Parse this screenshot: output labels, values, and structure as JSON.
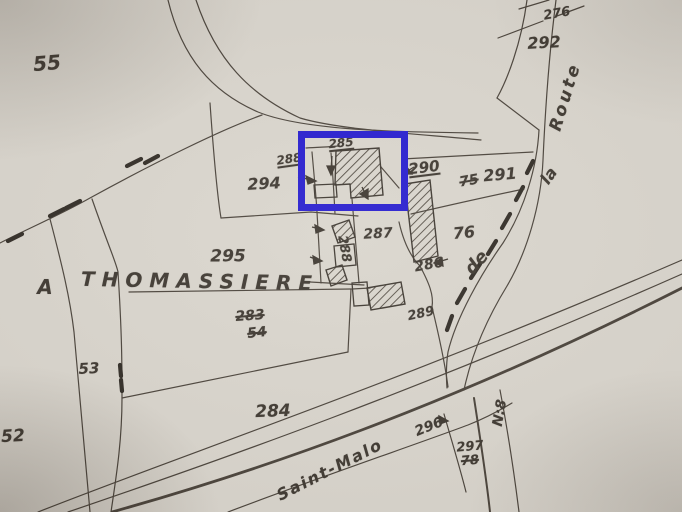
{
  "map_type": "cadastral parcel plan (scanned)",
  "palette": {
    "paper": "#d8d4cc",
    "ink": "#39332c",
    "hedge_ink": "#2c2721",
    "highlight_blue": "#2016ce"
  },
  "highlight_box": {
    "x": 298,
    "y": 131,
    "width": 110,
    "height": 80,
    "stroke_px": 7
  },
  "place_name": "A THOMASSIERE",
  "road_names": [
    "Route",
    "la",
    "de",
    "Saint-Malo",
    "N:8"
  ],
  "parcel_numbers_plain": [
    "55",
    "276",
    "292",
    "291",
    "76",
    "294",
    "287",
    "286",
    "289",
    "295",
    "53",
    "52",
    "284",
    "296",
    "297"
  ],
  "parcel_numbers_struck": [
    "75",
    "283",
    "54",
    "78"
  ],
  "parcel_numbers_underlined": [
    "290",
    "288",
    "285"
  ],
  "labels": [
    {
      "name": "parcel-label-55",
      "text": "55",
      "x": 47,
      "y": 63,
      "size": 20,
      "rot": -5,
      "style": "plain"
    },
    {
      "name": "parcel-label-276",
      "text": "276",
      "x": 557,
      "y": 14,
      "size": 13,
      "rot": -10,
      "style": "plain"
    },
    {
      "name": "parcel-label-292",
      "text": "292",
      "x": 544,
      "y": 43,
      "size": 16,
      "rot": -3,
      "style": "plain"
    },
    {
      "name": "road-label-route",
      "text": "Route",
      "x": 566,
      "y": 97,
      "size": 17,
      "rot": -73,
      "style": "plain",
      "spacing": 3
    },
    {
      "name": "road-label-la",
      "text": "la",
      "x": 549,
      "y": 176,
      "size": 16,
      "rot": -55,
      "style": "plain"
    },
    {
      "name": "road-label-de",
      "text": "de",
      "x": 477,
      "y": 263,
      "size": 18,
      "rot": -48,
      "style": "plain"
    },
    {
      "name": "parcel-label-290",
      "text": "290",
      "x": 424,
      "y": 168,
      "size": 15,
      "rot": -7,
      "style": "underline"
    },
    {
      "name": "parcel-label-75",
      "text": "75",
      "x": 469,
      "y": 181,
      "size": 14,
      "rot": -10,
      "style": "struck"
    },
    {
      "name": "parcel-label-291",
      "text": "291",
      "x": 500,
      "y": 175,
      "size": 16,
      "rot": -5,
      "style": "plain"
    },
    {
      "name": "parcel-label-76",
      "text": "76",
      "x": 464,
      "y": 233,
      "size": 16,
      "rot": -5,
      "style": "plain"
    },
    {
      "name": "parcel-label-294",
      "text": "294",
      "x": 264,
      "y": 184,
      "size": 16,
      "rot": -3,
      "style": "plain"
    },
    {
      "name": "parcel-label-288",
      "text": "288",
      "x": 289,
      "y": 159,
      "size": 12,
      "rot": -8,
      "style": "underline"
    },
    {
      "name": "parcel-label-285",
      "text": "285",
      "x": 341,
      "y": 143,
      "size": 12,
      "rot": -6,
      "style": "underline"
    },
    {
      "name": "parcel-label-287",
      "text": "287",
      "x": 378,
      "y": 234,
      "size": 14,
      "rot": -3,
      "style": "plain"
    },
    {
      "name": "parcel-label-288-vertical",
      "text": "288",
      "x": 344,
      "y": 249,
      "size": 13,
      "rot": 80,
      "style": "plain"
    },
    {
      "name": "parcel-label-286",
      "text": "286",
      "x": 429,
      "y": 265,
      "size": 14,
      "rot": -10,
      "style": "plain"
    },
    {
      "name": "parcel-label-289",
      "text": "289",
      "x": 421,
      "y": 314,
      "size": 13,
      "rot": -12,
      "style": "plain"
    },
    {
      "name": "parcel-label-295",
      "text": "295",
      "x": 228,
      "y": 257,
      "size": 17,
      "rot": 0,
      "style": "plain"
    },
    {
      "name": "place-label-a",
      "text": "A",
      "x": 45,
      "y": 287,
      "size": 20,
      "rot": 0,
      "style": "plain",
      "bold": true
    },
    {
      "name": "place-label-thomassiere",
      "text": "THOMASSIERE",
      "x": 200,
      "y": 281,
      "size": 20,
      "rot": 1,
      "style": "plain",
      "bold": true,
      "spacing": 7
    },
    {
      "name": "parcel-label-283",
      "text": "283",
      "x": 250,
      "y": 316,
      "size": 14,
      "rot": -4,
      "style": "struck"
    },
    {
      "name": "parcel-label-54",
      "text": "54",
      "x": 257,
      "y": 333,
      "size": 14,
      "rot": -6,
      "style": "struck"
    },
    {
      "name": "parcel-label-53",
      "text": "53",
      "x": 89,
      "y": 369,
      "size": 15,
      "rot": -3,
      "style": "plain"
    },
    {
      "name": "parcel-label-52",
      "text": "52",
      "x": 13,
      "y": 437,
      "size": 17,
      "rot": -3,
      "style": "plain"
    },
    {
      "name": "parcel-label-284",
      "text": "284",
      "x": 273,
      "y": 412,
      "size": 17,
      "rot": -2,
      "style": "plain"
    },
    {
      "name": "parcel-label-296",
      "text": "296",
      "x": 429,
      "y": 427,
      "size": 14,
      "rot": -22,
      "style": "plain"
    },
    {
      "name": "road-label-saint-malo",
      "text": "Saint-Malo",
      "x": 330,
      "y": 470,
      "size": 16,
      "rot": -27,
      "style": "plain",
      "spacing": 2
    },
    {
      "name": "parcel-label-297",
      "text": "297",
      "x": 470,
      "y": 447,
      "size": 13,
      "rot": -5,
      "style": "plain"
    },
    {
      "name": "parcel-label-78",
      "text": "78",
      "x": 470,
      "y": 461,
      "size": 13,
      "rot": -5,
      "style": "struck"
    },
    {
      "name": "road-label-n8",
      "text": "N:8",
      "x": 500,
      "y": 413,
      "size": 14,
      "rot": -80,
      "style": "plain"
    }
  ]
}
